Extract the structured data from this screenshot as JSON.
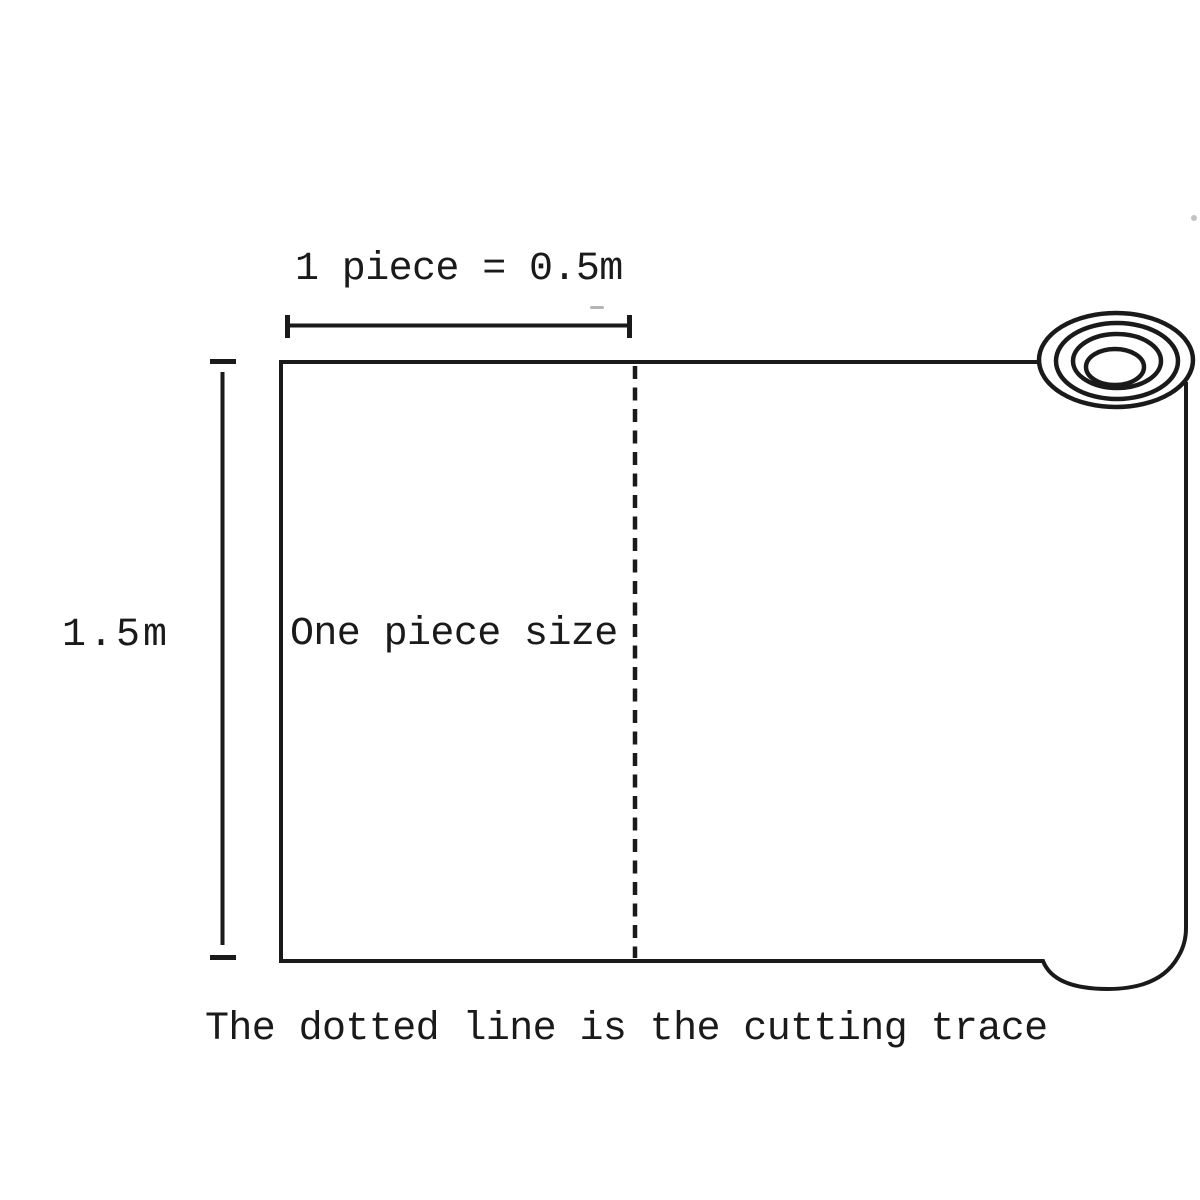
{
  "diagram": {
    "labels": {
      "width_dimension": "1 piece = 0.5m",
      "height_dimension": "1.5m",
      "piece_size": "One piece size",
      "caption": "The dotted line is the cutting trace"
    },
    "measurements": {
      "piece_width": "0.5m",
      "roll_height": "1.5m"
    },
    "icons": {
      "fabric_roll": "concentric-ellipses-roll-end",
      "cutting_line": "vertical-dashed-line"
    }
  },
  "colors": {
    "line": "#1a1a1a",
    "background": "#ffffff",
    "artifact": "#b5b5b5"
  }
}
